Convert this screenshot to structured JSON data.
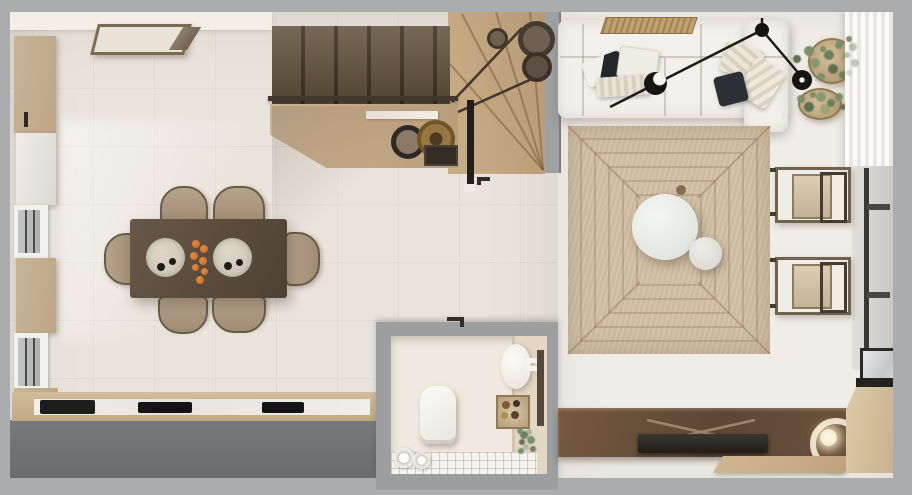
{
  "scene": {
    "description": "Photorealistic top-down 3D render of a small apartment floor plan",
    "view": "top-down",
    "rooms": [
      {
        "id": "kitchen-dining",
        "name": "kitchen and dining area"
      },
      {
        "id": "staircase",
        "name": "winder staircase"
      },
      {
        "id": "bathroom",
        "name": "bathroom"
      },
      {
        "id": "living-room",
        "name": "living room"
      }
    ],
    "furniture": {
      "kitchen_dining": [
        "wall cabinets with windows",
        "framed artwork",
        "dining table",
        "six upholstered chairs",
        "two round placemats with bowls",
        "orange fruit centerpiece",
        "kitchen counter with sink and two cooktops"
      ],
      "staircase": [
        "dark wood straight treads",
        "light wood winder treads",
        "handrail",
        "newel post",
        "under-stair sideboard with bowls and box",
        "decorative pots on landing"
      ],
      "bathroom": [
        "toilet",
        "round basin",
        "round shelf with bottles",
        "plant",
        "rolled towels",
        "tiled floor strip"
      ],
      "living_room": [
        "white modular sofa with pillows",
        "woven tray on sofa back",
        "black multi-arm ceiling lamp",
        "two potted plants in baskets",
        "jute rug with concentric pattern",
        "round coffee table",
        "round side table",
        "two wood-frame lounge chairs",
        "radiator on right wall",
        "sheer curtain",
        "bronze media console",
        "flat TV on easel",
        "circular ring lamp",
        "wood floor plank",
        "corner window with wood sill"
      ]
    }
  },
  "colors": {
    "mat": "#aaacad",
    "wallCream": "#f3efe7",
    "floorKitchen": "#e9e4db",
    "floorLiving": "#f0ede7",
    "woodPanel": "#c9b497",
    "sofa": "#f2f0ea",
    "rug": "#cdbaa0",
    "bathCream": "#efe9df",
    "accentOrange": "#d2752e",
    "stairDark": "#6b5d4b",
    "consoleBronze": "#5c4734",
    "plantGreen": "#7c8e6a"
  }
}
